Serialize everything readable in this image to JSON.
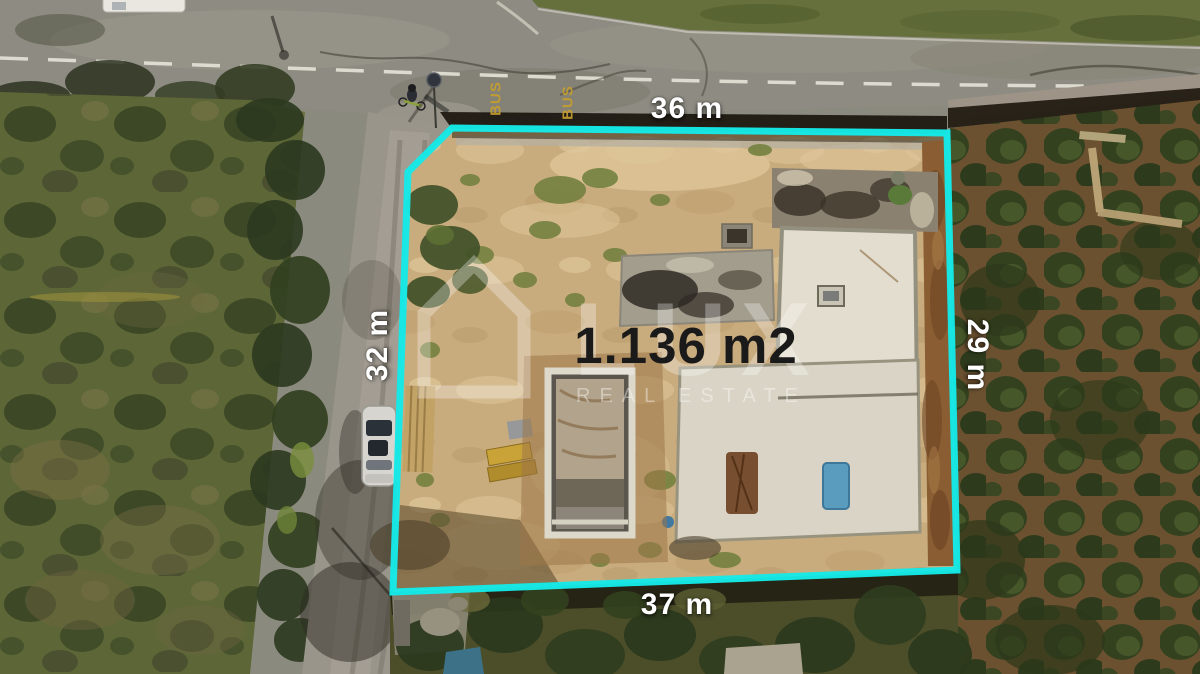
{
  "photo": {
    "area_label": "1.136 m2",
    "dimensions": {
      "top": "36 m",
      "left": "32 m",
      "right": "29 m",
      "bottom": "37 m"
    },
    "road_markings": {
      "bus_left": "BUS",
      "bus_right": "BUS"
    },
    "watermark": {
      "brand": "LUX",
      "tagline": "REAL ESTATE"
    },
    "colors": {
      "boundary_line": "#15E9E7",
      "area_text": "#1A1A1A",
      "dimension_text": "#FFFFFF",
      "bus_marking": "#C59E2E",
      "watermark_white": "rgba(255,255,255,0.32)"
    }
  }
}
